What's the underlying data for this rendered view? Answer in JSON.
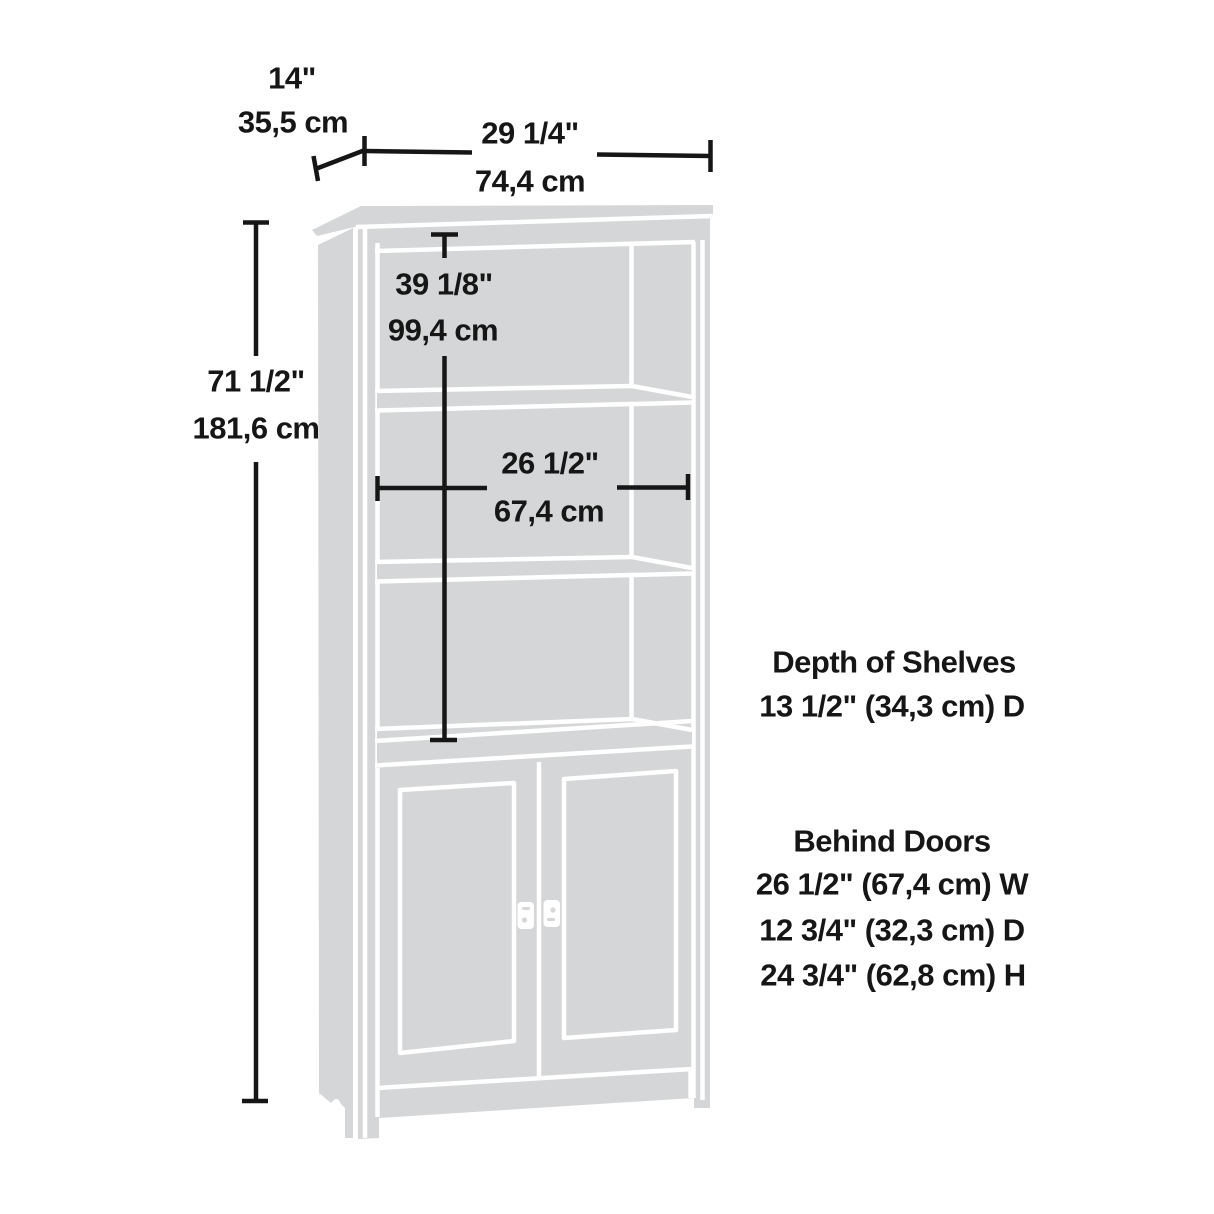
{
  "figure": {
    "kind": "product-dimension-line-drawing",
    "subject": "tall bookcase with lower doors"
  },
  "dimension_labels": {
    "depth": {
      "inches": "14\"",
      "cm": "35,5 cm"
    },
    "width": {
      "inches": "29 1/4\"",
      "cm": "74,4 cm"
    },
    "height": {
      "inches": "71 1/2\"",
      "cm": "181,6 cm"
    },
    "upper_opening_height": {
      "inches": "39 1/8\"",
      "cm": "99,4 cm"
    },
    "interior_width": {
      "inches": "26 1/2\"",
      "cm": "67,4 cm"
    }
  },
  "annotations": {
    "shelf_depth": {
      "title": "Depth of Shelves",
      "value": "13 1/2\" (34,3 cm) D"
    },
    "behind_doors": {
      "title": "Behind Doors",
      "lines": [
        "26 1/2\" (67,4 cm) W",
        "12 3/4\" (32,3 cm) D",
        "24 3/4\" (62,8 cm) H"
      ]
    }
  },
  "colors": {
    "background": "#ffffff",
    "artwork_gray": "#d5d6d7",
    "outline_white": "#ffffff",
    "ink": "#161616"
  }
}
